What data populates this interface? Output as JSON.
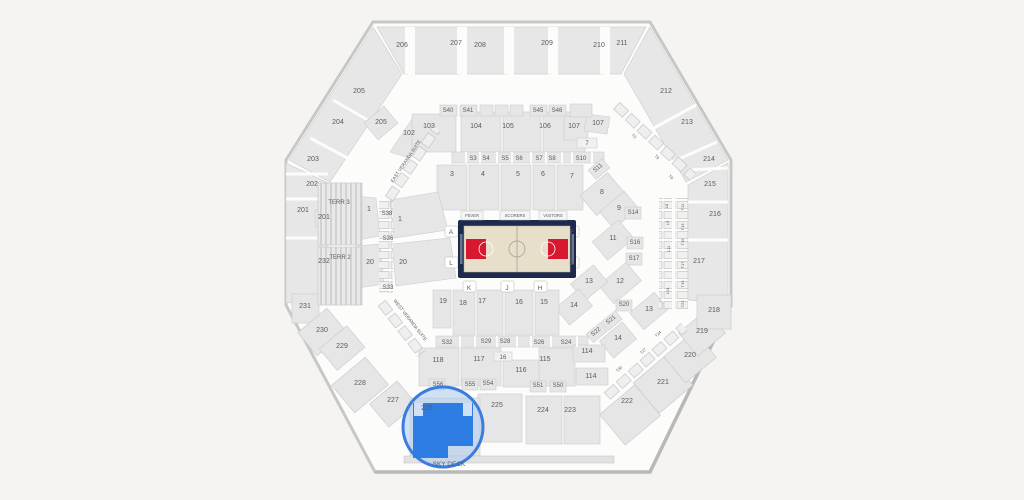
{
  "page": {
    "background": "#f5f4f1"
  },
  "map": {
    "highlighted_section": "226",
    "colors": {
      "highlight_fill": "#2e7de3",
      "highlight_ring": "#3b7ce0",
      "lens_tint": "#adcaf0",
      "court_border": "#1c2b4d",
      "court_floor": "#e8dfca",
      "key_red": "#d7182f",
      "block_gray": "#e6e6e6",
      "outline_gray": "#c7c7c6"
    },
    "labels": [
      {
        "t": "206",
        "x": 402,
        "y": 47,
        "k": "section",
        "i": true
      },
      {
        "t": "207",
        "x": 456,
        "y": 45,
        "k": "section",
        "i": true
      },
      {
        "t": "208",
        "x": 480,
        "y": 47,
        "k": "section",
        "i": true
      },
      {
        "t": "209",
        "x": 547,
        "y": 45,
        "k": "section",
        "i": true
      },
      {
        "t": "210",
        "x": 599,
        "y": 47,
        "k": "section",
        "i": true
      },
      {
        "t": "211",
        "x": 622,
        "y": 45,
        "k": "section",
        "i": true
      },
      {
        "t": "205",
        "x": 359,
        "y": 93,
        "k": "section",
        "i": true
      },
      {
        "t": "204",
        "x": 338,
        "y": 124,
        "k": "section",
        "i": true
      },
      {
        "t": "205",
        "x": 381,
        "y": 124,
        "k": "section",
        "i": true
      },
      {
        "t": "203",
        "x": 313,
        "y": 161,
        "k": "section",
        "i": true
      },
      {
        "t": "202",
        "x": 312,
        "y": 186,
        "k": "section",
        "i": true
      },
      {
        "t": "201",
        "x": 303,
        "y": 212,
        "k": "section",
        "i": true
      },
      {
        "t": "201",
        "x": 324,
        "y": 219,
        "k": "section",
        "i": true
      },
      {
        "t": "232",
        "x": 324,
        "y": 263,
        "k": "section",
        "i": true
      },
      {
        "t": "231",
        "x": 305,
        "y": 308,
        "k": "section",
        "i": true
      },
      {
        "t": "230",
        "x": 322,
        "y": 332,
        "k": "section",
        "i": true
      },
      {
        "t": "229",
        "x": 342,
        "y": 348,
        "k": "section",
        "i": true
      },
      {
        "t": "228",
        "x": 360,
        "y": 385,
        "k": "section",
        "i": true
      },
      {
        "t": "227",
        "x": 393,
        "y": 402,
        "k": "section",
        "i": true
      },
      {
        "t": "212",
        "x": 666,
        "y": 93,
        "k": "section",
        "i": true
      },
      {
        "t": "213",
        "x": 687,
        "y": 124,
        "k": "section",
        "i": true
      },
      {
        "t": "214",
        "x": 709,
        "y": 161,
        "k": "section",
        "i": true
      },
      {
        "t": "215",
        "x": 710,
        "y": 186,
        "k": "section",
        "i": true
      },
      {
        "t": "216",
        "x": 715,
        "y": 216,
        "k": "section",
        "i": true
      },
      {
        "t": "217",
        "x": 699,
        "y": 263,
        "k": "section",
        "i": true
      },
      {
        "t": "218",
        "x": 714,
        "y": 312,
        "k": "section",
        "i": true
      },
      {
        "t": "219",
        "x": 702,
        "y": 333,
        "k": "section",
        "i": true
      },
      {
        "t": "220",
        "x": 690,
        "y": 357,
        "k": "section",
        "i": true
      },
      {
        "t": "221",
        "x": 663,
        "y": 384,
        "k": "section",
        "i": true
      },
      {
        "t": "222",
        "x": 627,
        "y": 403,
        "k": "section",
        "i": true
      },
      {
        "t": "225",
        "x": 497,
        "y": 407,
        "k": "section",
        "i": true
      },
      {
        "t": "224",
        "x": 543,
        "y": 412,
        "k": "section",
        "i": true
      },
      {
        "t": "223",
        "x": 570,
        "y": 412,
        "k": "section",
        "i": true
      },
      {
        "t": "226",
        "x": 427,
        "y": 410,
        "s": 7,
        "c": "#1e3a6d",
        "k": "section-highlighted",
        "i": true
      },
      {
        "t": "102",
        "x": 409,
        "y": 135,
        "k": "section",
        "i": true
      },
      {
        "t": "103",
        "x": 429,
        "y": 128,
        "k": "section",
        "i": true
      },
      {
        "t": "104",
        "x": 476,
        "y": 128,
        "k": "section",
        "i": true
      },
      {
        "t": "105",
        "x": 508,
        "y": 128,
        "k": "section",
        "i": true
      },
      {
        "t": "106",
        "x": 545,
        "y": 128,
        "k": "section",
        "i": true
      },
      {
        "t": "107",
        "x": 574,
        "y": 128,
        "k": "section",
        "i": true
      },
      {
        "t": "107",
        "x": 598,
        "y": 125,
        "k": "section",
        "i": true
      },
      {
        "t": "118",
        "x": 438,
        "y": 362,
        "k": "section",
        "i": true
      },
      {
        "t": "117",
        "x": 479,
        "y": 361,
        "k": "section",
        "i": true
      },
      {
        "t": "116",
        "x": 521,
        "y": 372,
        "k": "section",
        "i": true
      },
      {
        "t": "115",
        "x": 545,
        "y": 361,
        "k": "section",
        "i": true
      },
      {
        "t": "114",
        "x": 587,
        "y": 353,
        "k": "section",
        "i": true
      },
      {
        "t": "114",
        "x": 591,
        "y": 378,
        "k": "section",
        "i": true
      },
      {
        "t": "S40",
        "x": 448,
        "y": 112,
        "s": 6,
        "k": "suite",
        "i": true
      },
      {
        "t": "S41",
        "x": 468,
        "y": 112,
        "s": 6,
        "k": "suite",
        "i": true
      },
      {
        "t": "S45",
        "x": 538,
        "y": 112,
        "s": 6,
        "k": "suite",
        "i": true
      },
      {
        "t": "S46",
        "x": 557,
        "y": 112,
        "s": 6,
        "k": "suite",
        "i": true
      },
      {
        "t": "S3",
        "x": 473,
        "y": 160,
        "s": 6,
        "k": "suite",
        "i": true
      },
      {
        "t": "S4",
        "x": 486,
        "y": 160,
        "s": 6,
        "k": "suite",
        "i": true
      },
      {
        "t": "S5",
        "x": 505,
        "y": 160,
        "s": 6,
        "k": "suite",
        "i": true
      },
      {
        "t": "S6",
        "x": 519,
        "y": 160,
        "s": 6,
        "k": "suite",
        "i": true
      },
      {
        "t": "S7",
        "x": 539,
        "y": 160,
        "s": 6,
        "k": "suite",
        "i": true
      },
      {
        "t": "S8",
        "x": 552,
        "y": 160,
        "s": 6,
        "k": "suite",
        "i": true
      },
      {
        "t": "S10",
        "x": 581,
        "y": 160,
        "s": 6,
        "k": "suite",
        "i": true
      },
      {
        "t": "S11",
        "x": 599,
        "y": 169,
        "s": 6,
        "r": -40,
        "k": "suite",
        "i": true
      },
      {
        "t": "S14",
        "x": 633,
        "y": 214,
        "s": 6,
        "k": "suite",
        "i": true
      },
      {
        "t": "S16",
        "x": 635,
        "y": 244,
        "s": 6,
        "k": "suite",
        "i": true
      },
      {
        "t": "S17",
        "x": 634,
        "y": 260,
        "s": 6,
        "k": "suite",
        "i": true
      },
      {
        "t": "S20",
        "x": 624,
        "y": 306,
        "s": 6,
        "k": "suite",
        "i": true
      },
      {
        "t": "S21",
        "x": 612,
        "y": 321,
        "s": 6,
        "r": -40,
        "k": "suite",
        "i": true
      },
      {
        "t": "S22",
        "x": 597,
        "y": 333,
        "s": 6,
        "r": -40,
        "k": "suite",
        "i": true
      },
      {
        "t": "S24",
        "x": 566,
        "y": 344,
        "s": 6,
        "k": "suite",
        "i": true
      },
      {
        "t": "S26",
        "x": 539,
        "y": 344,
        "s": 6,
        "k": "suite",
        "i": true
      },
      {
        "t": "S28",
        "x": 505,
        "y": 343,
        "s": 6,
        "k": "suite",
        "i": true
      },
      {
        "t": "S29",
        "x": 486,
        "y": 343,
        "s": 6,
        "k": "suite",
        "i": true
      },
      {
        "t": "S32",
        "x": 447,
        "y": 344,
        "s": 6,
        "k": "suite",
        "i": true
      },
      {
        "t": "S33",
        "x": 388,
        "y": 289,
        "s": 6,
        "k": "suite",
        "i": true
      },
      {
        "t": "S36",
        "x": 388,
        "y": 240,
        "s": 6,
        "k": "suite",
        "i": true
      },
      {
        "t": "S38",
        "x": 387,
        "y": 215,
        "s": 6,
        "k": "suite",
        "i": true
      },
      {
        "t": "S50",
        "x": 558,
        "y": 387,
        "s": 6,
        "k": "suite",
        "i": true
      },
      {
        "t": "S51",
        "x": 538,
        "y": 387,
        "s": 6,
        "k": "suite",
        "i": true
      },
      {
        "t": "S54",
        "x": 488,
        "y": 385,
        "s": 6,
        "k": "suite",
        "i": true
      },
      {
        "t": "S55",
        "x": 470,
        "y": 386,
        "s": 6,
        "k": "suite",
        "i": true
      },
      {
        "t": "S56",
        "x": 438,
        "y": 386,
        "s": 6,
        "k": "suite",
        "i": true
      },
      {
        "t": "1",
        "x": 369,
        "y": 211,
        "k": "floor",
        "i": true
      },
      {
        "t": "1",
        "x": 400,
        "y": 221,
        "k": "floor",
        "i": true
      },
      {
        "t": "3",
        "x": 452,
        "y": 176,
        "k": "floor",
        "i": true
      },
      {
        "t": "4",
        "x": 483,
        "y": 176,
        "k": "floor",
        "i": true
      },
      {
        "t": "5",
        "x": 518,
        "y": 176,
        "k": "floor",
        "i": true
      },
      {
        "t": "6",
        "x": 543,
        "y": 176,
        "k": "floor",
        "i": true
      },
      {
        "t": "7",
        "x": 572,
        "y": 178,
        "k": "floor",
        "i": true
      },
      {
        "t": "7",
        "x": 587,
        "y": 145,
        "s": 6,
        "k": "floor",
        "i": true
      },
      {
        "t": "8",
        "x": 602,
        "y": 194,
        "k": "floor",
        "i": true
      },
      {
        "t": "9",
        "x": 619,
        "y": 210,
        "k": "floor",
        "i": true
      },
      {
        "t": "11",
        "x": 613,
        "y": 240,
        "k": "floor",
        "i": true
      },
      {
        "t": "12",
        "x": 620,
        "y": 283,
        "k": "floor",
        "i": true
      },
      {
        "t": "13",
        "x": 589,
        "y": 283,
        "k": "floor",
        "i": true
      },
      {
        "t": "13",
        "x": 649,
        "y": 311,
        "k": "floor",
        "i": true
      },
      {
        "t": "14",
        "x": 574,
        "y": 307,
        "k": "floor",
        "i": true
      },
      {
        "t": "14",
        "x": 618,
        "y": 340,
        "k": "floor",
        "i": true
      },
      {
        "t": "15",
        "x": 544,
        "y": 304,
        "k": "floor",
        "i": true
      },
      {
        "t": "16",
        "x": 519,
        "y": 304,
        "k": "floor",
        "i": true
      },
      {
        "t": "16",
        "x": 503,
        "y": 359,
        "s": 6,
        "k": "floor",
        "i": true
      },
      {
        "t": "17",
        "x": 482,
        "y": 303,
        "k": "floor",
        "i": true
      },
      {
        "t": "18",
        "x": 463,
        "y": 305,
        "k": "floor",
        "i": true
      },
      {
        "t": "19",
        "x": 443,
        "y": 303,
        "k": "floor",
        "i": true
      },
      {
        "t": "20",
        "x": 370,
        "y": 264,
        "k": "floor",
        "i": true
      },
      {
        "t": "20",
        "x": 403,
        "y": 264,
        "k": "floor",
        "i": true
      },
      {
        "t": "TERR 3",
        "x": 339,
        "y": 204,
        "s": 6,
        "k": "level",
        "i": true
      },
      {
        "t": "TERR 2",
        "x": 340,
        "y": 259,
        "s": 6,
        "k": "level",
        "i": true
      },
      {
        "t": "A",
        "x": 451,
        "y": 234,
        "s": 6.5,
        "c": "#6a6a6a",
        "k": "letter",
        "i": true
      },
      {
        "t": "F",
        "x": 572,
        "y": 234,
        "s": 6.5,
        "c": "#6a6a6a",
        "k": "letter",
        "i": true
      },
      {
        "t": "L",
        "x": 451,
        "y": 265,
        "s": 6.5,
        "c": "#6a6a6a",
        "k": "letter",
        "i": true
      },
      {
        "t": "G",
        "x": 572,
        "y": 265,
        "s": 6.5,
        "c": "#6a6a6a",
        "k": "letter",
        "i": true
      },
      {
        "t": "K",
        "x": 469,
        "y": 290,
        "s": 6.5,
        "c": "#6a6a6a",
        "k": "letter",
        "i": true
      },
      {
        "t": "J",
        "x": 507,
        "y": 290,
        "s": 6.5,
        "c": "#6a6a6a",
        "k": "letter",
        "i": true
      },
      {
        "t": "H",
        "x": 540,
        "y": 290,
        "s": 6.5,
        "c": "#6a6a6a",
        "k": "letter",
        "i": true
      },
      {
        "t": "FEVER",
        "x": 472,
        "y": 217,
        "s": 4.2,
        "c": "#2b3a5c",
        "k": "court-label",
        "i": false
      },
      {
        "t": "SCORERS",
        "x": 515,
        "y": 217,
        "s": 4.2,
        "c": "#2b3a5c",
        "k": "court-label",
        "i": false
      },
      {
        "t": "VISITORS",
        "x": 553,
        "y": 217,
        "s": 4.2,
        "c": "#2b3a5c",
        "k": "court-label",
        "i": false
      },
      {
        "t": "EAST VERANDA SUITE",
        "x": 407,
        "y": 162,
        "s": 4.6,
        "r": -56,
        "c": "#8a8a8a",
        "k": "area-label",
        "i": false
      },
      {
        "t": "WEST VERANDA SUITE",
        "x": 409,
        "y": 321,
        "s": 4.6,
        "r": 52,
        "c": "#8a8a8a",
        "k": "area-label",
        "i": false
      },
      {
        "t": "SKY DECK",
        "x": 449,
        "y": 466,
        "s": 6.5,
        "k": "area-label",
        "i": true
      },
      {
        "t": "T3",
        "x": 633,
        "y": 137,
        "s": 4,
        "r": 43,
        "k": "terrace-box",
        "i": true
      },
      {
        "t": "T6",
        "x": 656,
        "y": 158,
        "s": 4,
        "r": 43,
        "k": "terrace-box",
        "i": true
      },
      {
        "t": "T9",
        "x": 670,
        "y": 178,
        "s": 4,
        "r": 43,
        "k": "terrace-box",
        "i": true
      },
      {
        "t": "L8",
        "x": 668,
        "y": 206,
        "s": 4,
        "r": -90,
        "k": "terrace-box",
        "i": true
      },
      {
        "t": "L9",
        "x": 669,
        "y": 223,
        "s": 4,
        "r": -90,
        "k": "terrace-box",
        "i": true
      },
      {
        "t": "L11",
        "x": 670,
        "y": 249,
        "s": 4,
        "r": -90,
        "k": "terrace-box",
        "i": true
      },
      {
        "t": "L14",
        "x": 669,
        "y": 291,
        "s": 4,
        "r": -90,
        "k": "terrace-box",
        "i": true
      },
      {
        "t": "T11",
        "x": 684,
        "y": 207,
        "s": 4,
        "r": -90,
        "k": "terrace-box",
        "i": true
      },
      {
        "t": "T13",
        "x": 684,
        "y": 227,
        "s": 4,
        "r": -90,
        "k": "terrace-box",
        "i": true
      },
      {
        "t": "T15",
        "x": 684,
        "y": 242,
        "s": 4,
        "r": -90,
        "k": "terrace-box",
        "i": true
      },
      {
        "t": "T17",
        "x": 684,
        "y": 265,
        "s": 4,
        "r": -90,
        "k": "terrace-box",
        "i": true
      },
      {
        "t": "T19",
        "x": 684,
        "y": 284,
        "s": 4,
        "r": -90,
        "k": "terrace-box",
        "i": true
      },
      {
        "t": "T21",
        "x": 684,
        "y": 304,
        "s": 4,
        "r": -90,
        "k": "terrace-box",
        "i": true
      },
      {
        "t": "T24",
        "x": 659,
        "y": 335,
        "s": 4,
        "r": -43,
        "k": "terrace-box",
        "i": true
      },
      {
        "t": "T27",
        "x": 644,
        "y": 352,
        "s": 4,
        "r": -43,
        "k": "terrace-box",
        "i": true
      },
      {
        "t": "T30",
        "x": 620,
        "y": 370,
        "s": 4,
        "r": -43,
        "k": "terrace-box",
        "i": true
      }
    ]
  }
}
